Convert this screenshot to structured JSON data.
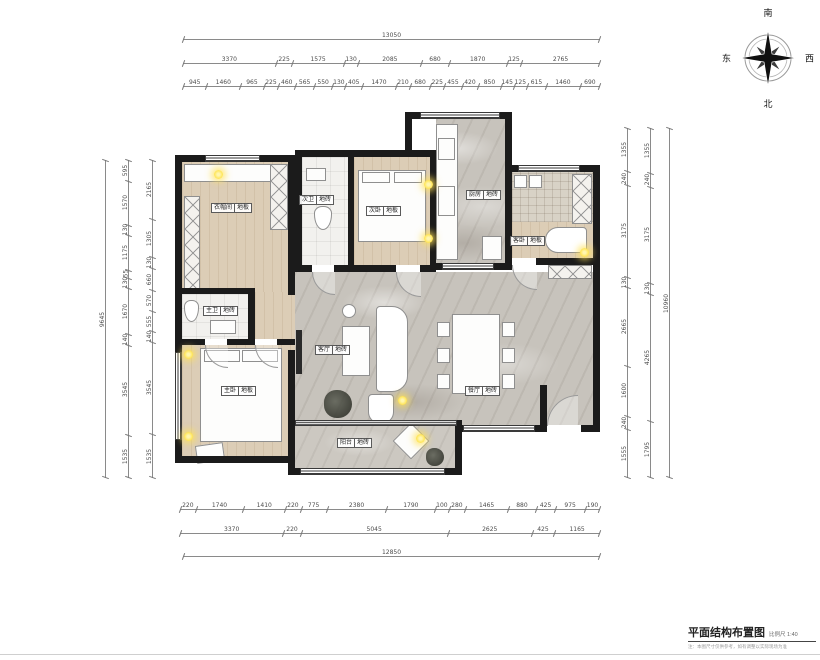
{
  "compass": {
    "top": "南",
    "bottom": "北",
    "left": "东",
    "right": "西"
  },
  "dimensions": {
    "top": {
      "total": "13050",
      "row2": [
        "3370",
        "225",
        "1575",
        "130",
        "2085",
        "680",
        "1870",
        "125",
        "2765"
      ],
      "row3": [
        "945",
        "1460",
        "965",
        "225",
        "460",
        "565",
        "550",
        "130",
        "405",
        "1470",
        "210",
        "680",
        "225",
        "455",
        "420",
        "850",
        "145",
        "125",
        "615",
        "1460",
        "690"
      ]
    },
    "bottom": {
      "row1": [
        "220",
        "1740",
        "1410",
        "220",
        "775",
        "2380",
        "1790",
        "100",
        "280",
        "1465",
        "880",
        "425",
        "975",
        "190"
      ],
      "row2": [
        "3370",
        "220",
        "5045",
        "2625",
        "425",
        "1165"
      ],
      "total": "12850"
    },
    "left": {
      "total": "9645",
      "colA": [
        "595",
        "1570",
        "130",
        "1175",
        "55",
        "130",
        "1670",
        "140",
        "3545",
        "1535"
      ],
      "colB": [
        "2165",
        "1305",
        "130",
        "660",
        "570",
        "555",
        "140",
        "3545",
        "1535"
      ]
    },
    "right": {
      "total": "10960",
      "colMid": [
        "1355",
        "240",
        "3175",
        "130",
        "4265",
        "1795"
      ],
      "colInner": [
        "1355",
        "240",
        "3175",
        "130",
        "2665",
        "1600",
        "240",
        "1555"
      ]
    }
  },
  "rooms": [
    {
      "id": "cloakroom",
      "name": "衣帽间",
      "material": "地板"
    },
    {
      "id": "bath2",
      "name": "次卫",
      "material": "地砖"
    },
    {
      "id": "bed2",
      "name": "次卧",
      "material": "地板"
    },
    {
      "id": "kitchen",
      "name": "厨房",
      "material": "地砖"
    },
    {
      "id": "guestbed",
      "name": "客卧",
      "material": "地板"
    },
    {
      "id": "bath1",
      "name": "主卫",
      "material": "地砖"
    },
    {
      "id": "bed1",
      "name": "主卧",
      "material": "地板"
    },
    {
      "id": "living",
      "name": "客厅",
      "material": "地砖"
    },
    {
      "id": "dining",
      "name": "餐厅",
      "material": "地砖"
    },
    {
      "id": "balcony",
      "name": "阳台",
      "material": "地砖"
    }
  ],
  "title_block": {
    "title": "平面结构布置图",
    "scale": "比例尺 1:40",
    "note": "注：本图尺寸仅供参考，如有调整以实际现场为准"
  }
}
